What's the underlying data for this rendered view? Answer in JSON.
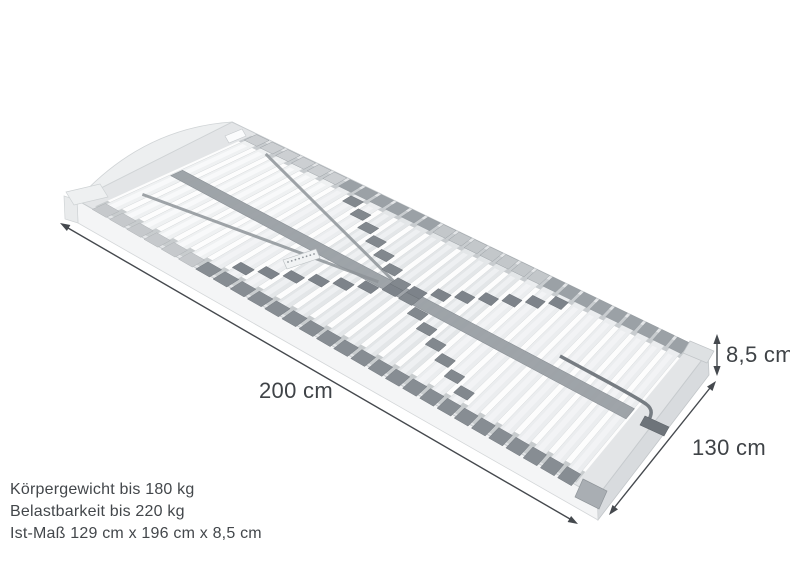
{
  "illustration": {
    "subject": "Lattenrost (slatted bed base), perspective view",
    "slat_count": 28
  },
  "dimensions": {
    "length": "200 cm",
    "width": "130 cm",
    "height": "8,5 cm"
  },
  "specs": {
    "lines": [
      "Körpergewicht bis 180 kg",
      "Belastbarkeit bis 220 kg",
      "Ist-Maß 129 cm x 196 cm x 8,5 cm"
    ]
  },
  "colors": {
    "background": "#ffffff",
    "dimension_lines": "#45494e",
    "label_text": "#3f4347",
    "spec_text": "#43474b",
    "frame_top": "#e3e5e7",
    "frame_side_near": "#f4f5f6",
    "frame_side_foot": "#d8dbde",
    "slat": "#ebedef",
    "slat_cap_dark": "#878d93",
    "slat_cap_light": "#c6c9cc",
    "center_strap": "#9aa0a5",
    "slider": "#7d838a"
  }
}
